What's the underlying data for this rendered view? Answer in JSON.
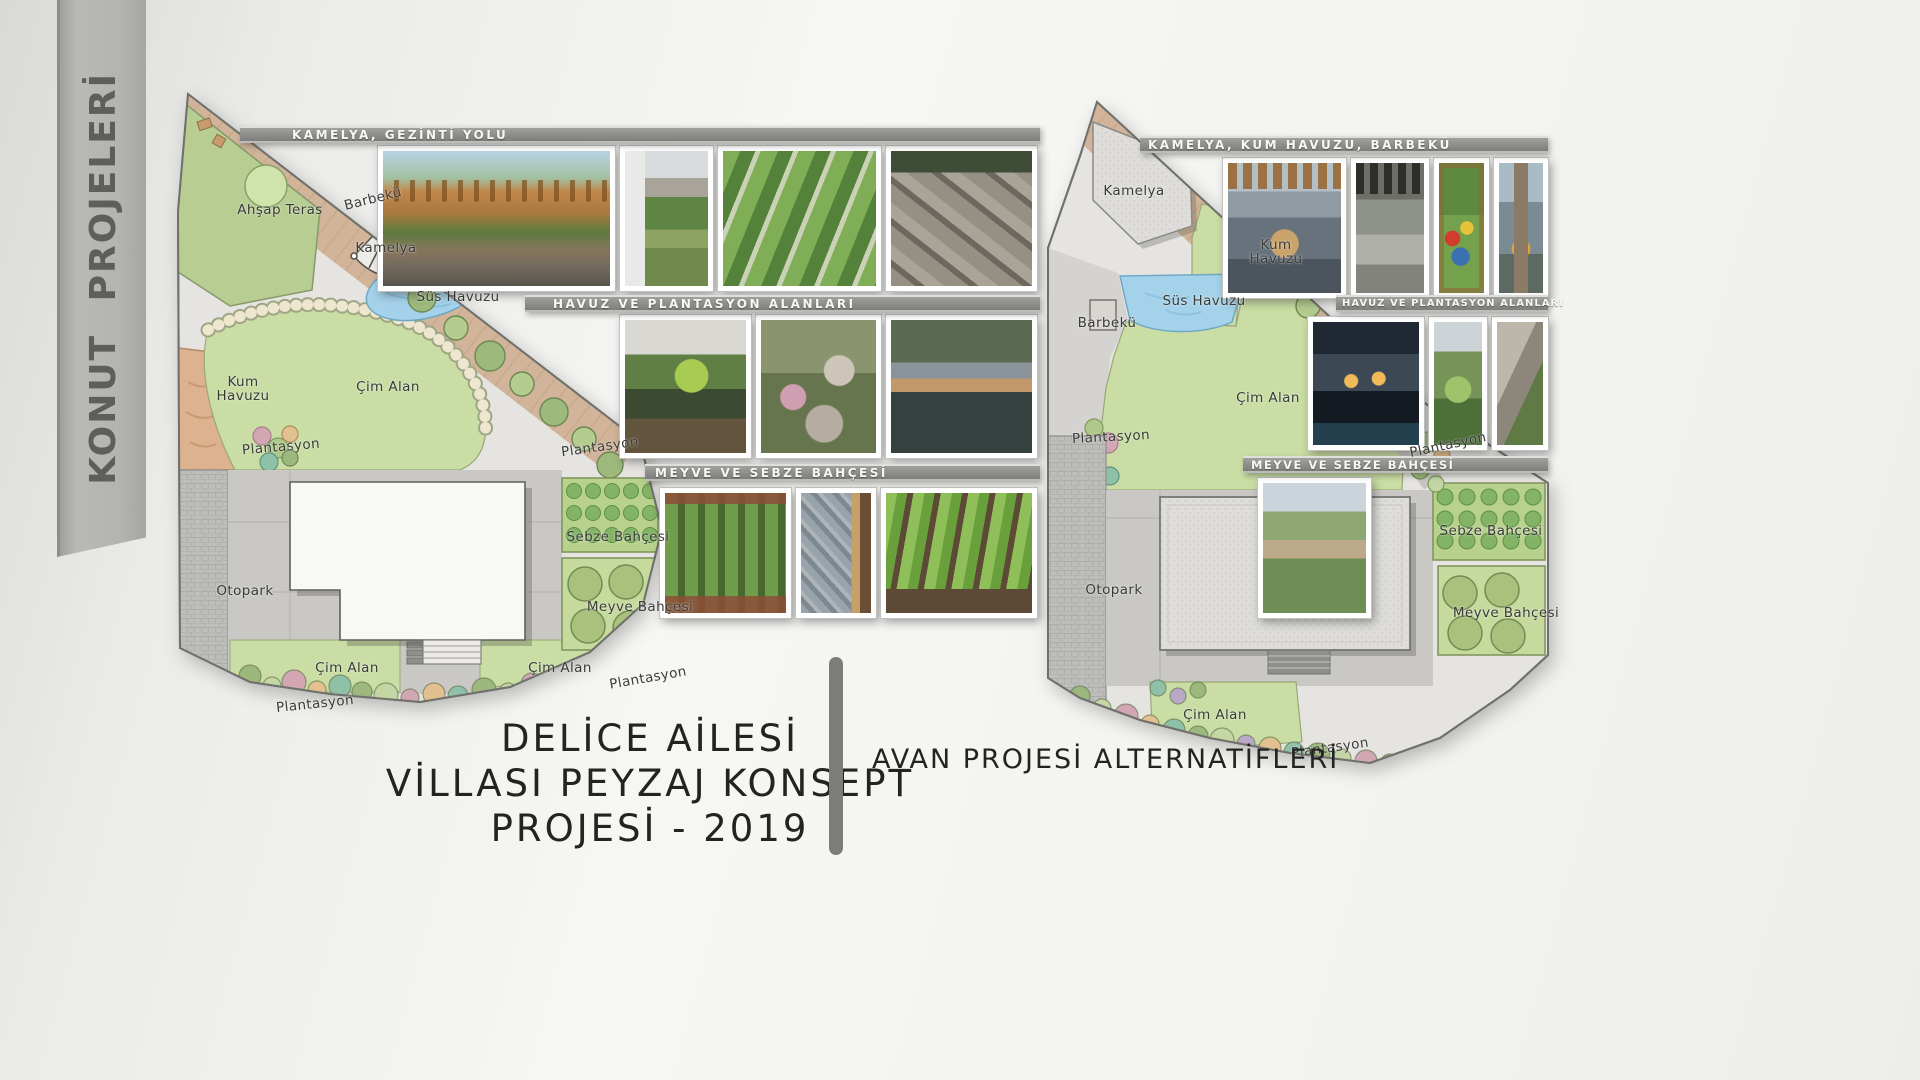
{
  "banner": {
    "text": "KONUT PROJELERİ"
  },
  "left": {
    "strips": {
      "s1": "KAMELYA, GEZİNTİ YOLU",
      "s2": "HAVUZ VE PLANTASYON ALANLARI",
      "s3": "MEYVE VE SEBZE BAHÇESİ"
    },
    "labels": [
      {
        "text": "Ahşap Teras"
      },
      {
        "text": "Barbekü"
      },
      {
        "text": "Kamelya"
      },
      {
        "text": "Süs Havuzu"
      },
      {
        "text": "Kum Havuzu"
      },
      {
        "text": "Çim Alan"
      },
      {
        "text": "Plantasyon"
      },
      {
        "text": "Plantasyon"
      },
      {
        "text": "Otopark"
      },
      {
        "text": "Sebze Bahçesi"
      },
      {
        "text": "Meyve Bahçesi"
      },
      {
        "text": "Çim Alan"
      },
      {
        "text": "Çim Alan"
      },
      {
        "text": "Plantasyon"
      },
      {
        "text": "Plantasyon"
      }
    ]
  },
  "right": {
    "strips": {
      "s1": "KAMELYA, KUM HAVUZU, BARBEKÜ",
      "s2": "HAVUZ VE PLANTASYON ALANLARI",
      "s3": "MEYVE VE SEBZE BAHÇESİ"
    },
    "labels": [
      {
        "text": "Kamelya"
      },
      {
        "text": "Kum Havuzu"
      },
      {
        "text": "Süs Havuzu"
      },
      {
        "text": "Barbekü"
      },
      {
        "text": "Çim Alan"
      },
      {
        "text": "Plantasyon"
      },
      {
        "text": "Plantasyon"
      },
      {
        "text": "Sebze Bahçesi"
      },
      {
        "text": "Meyve Bahçesi"
      },
      {
        "text": "Otopark"
      },
      {
        "text": "Çim Alan"
      },
      {
        "text": "Plantasyon"
      }
    ]
  },
  "footer": {
    "title_line1": "DELİCE AİLESİ",
    "title_line2": "VİLLASI PEYZAJ KONSEPT",
    "title_line3": "PROJESİ - 2019",
    "subtitle": "AVAN PROJESİ ALTERNATİFLERİ"
  },
  "colors": {
    "lawn": "#c9dda4",
    "water": "#a4d2ea",
    "sand": "#ddb28f",
    "strip_bg": "#8e8e8c",
    "title_text": "#232321"
  }
}
